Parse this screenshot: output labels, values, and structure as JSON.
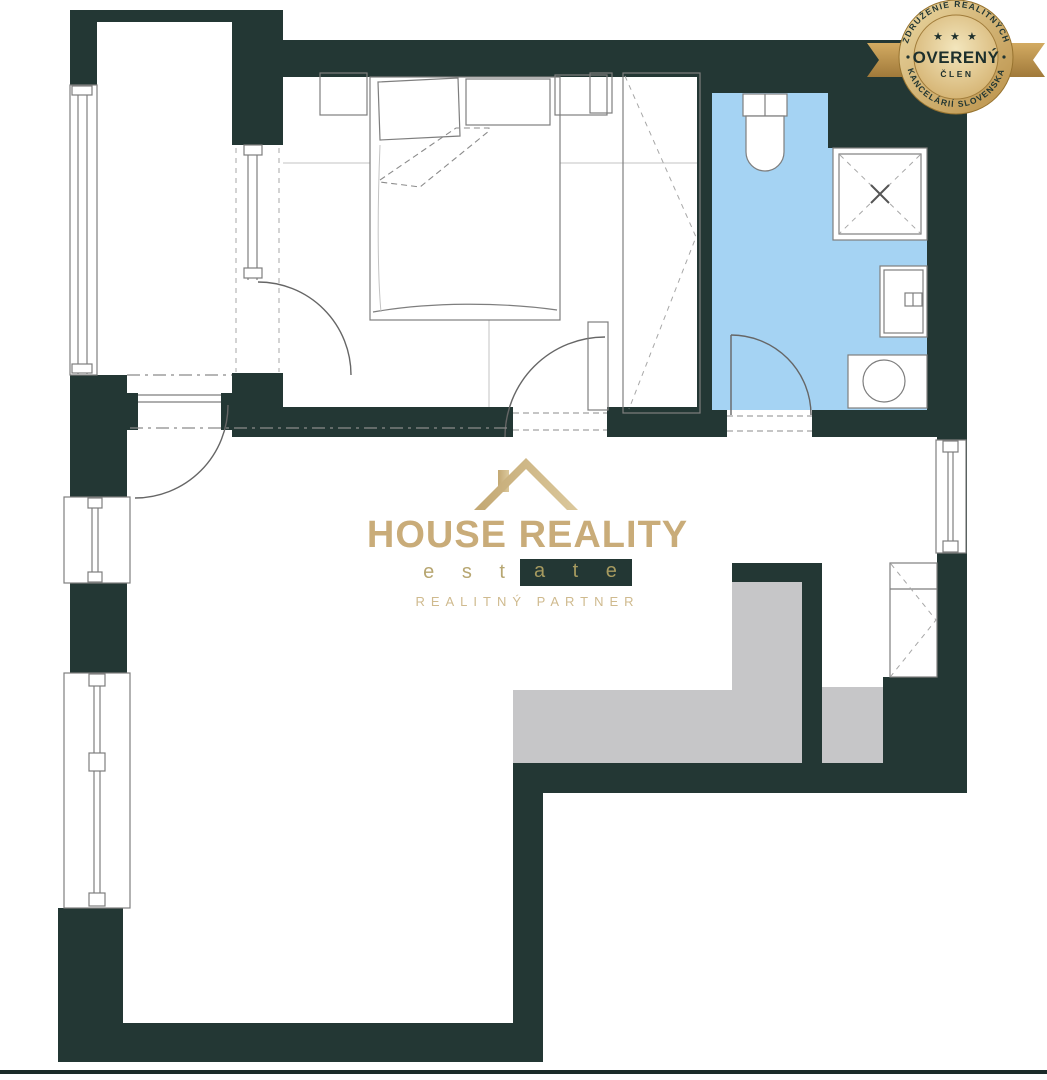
{
  "logo": {
    "title": "HOUSE REALITY",
    "estate_prefix": "e s t",
    "estate_suffix": "a t e",
    "tagline": "REALITNÝ PARTNER",
    "house_icon": "roof-with-chimney-icon",
    "colors": {
      "gold": "#c9ac79",
      "estate_box": "#233734",
      "tagline_gold": "#cfba8e"
    }
  },
  "badge": {
    "arc_top": "ZDRUŽENIE REALITNÝCH",
    "arc_bottom": "KANCELÁRIÍ SLOVENSKA",
    "stars": "★ ★ ★",
    "title": "OVERENÝ",
    "subtitle": "ČLEN",
    "colors": {
      "gold_light": "#ecd9a4",
      "gold_dark": "#b98f47",
      "text": "#1d2f2c"
    }
  },
  "plan": {
    "type": "apartment-floor-plan",
    "rooms": [
      "balcony",
      "bedroom",
      "bathroom",
      "living-room-with-kitchen",
      "entry"
    ],
    "fixtures": [
      "bed",
      "pillows",
      "nightstand",
      "wardrobe",
      "toilet",
      "shower",
      "sink",
      "washing-machine",
      "kitchen-counter",
      "windows",
      "doors"
    ],
    "colors": {
      "wall": "#233734",
      "bathroom_floor": "#a5d3f3",
      "kitchen_counter": "#c6c6c8",
      "floor": "#ffffff",
      "line": "#7e7e7e",
      "bottom_border": "#1b2b29"
    }
  }
}
